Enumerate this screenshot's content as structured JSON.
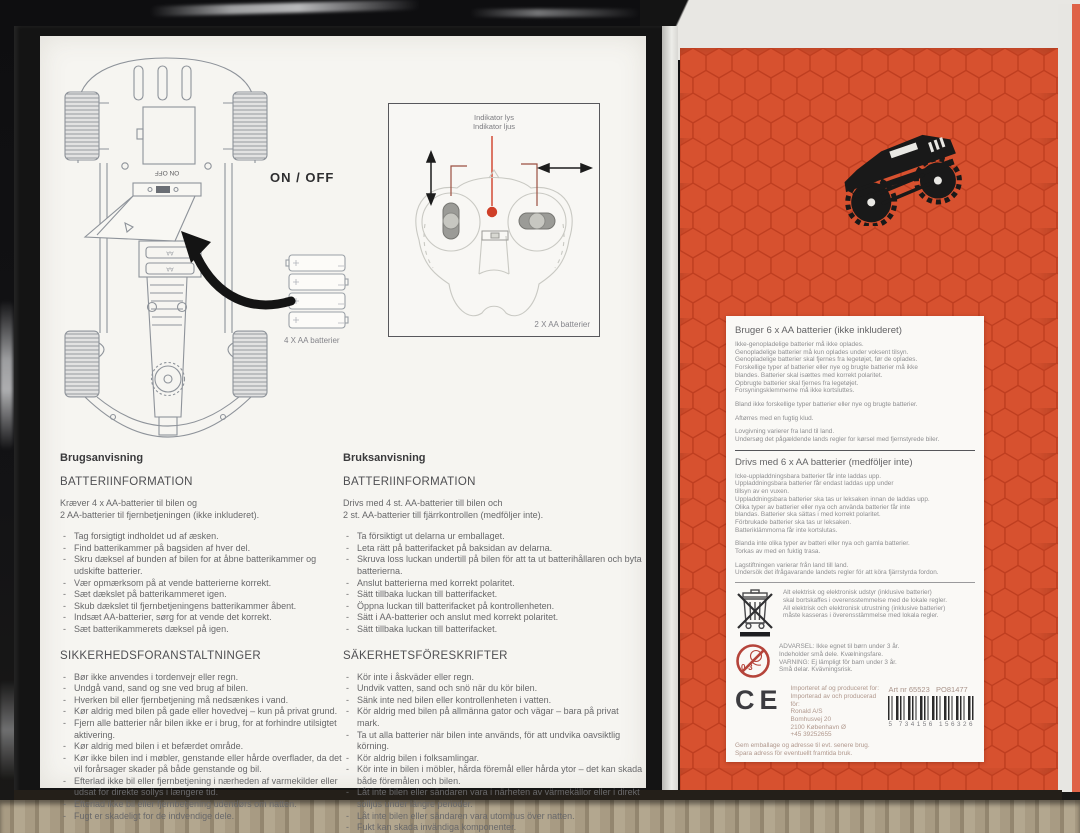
{
  "panel_left": {
    "diagrams": {
      "on_off_label": "ON / OFF",
      "car_batteries_label": "4 X AA batterier",
      "compartment_switch_label": "ON  OFF",
      "battery_slot_label": "AA",
      "remote": {
        "indicator_line1": "Indikator lys",
        "indicator_line2": "Indikator ljus",
        "batteries_label": "2 X AA batterier"
      }
    },
    "danish": {
      "title": "Brugsanvisning",
      "battery_header": "BATTERIINFORMATION",
      "battery_intro": [
        "Kræver 4 x AA-batterier til bilen og",
        "2 AA-batterier til fjernbetjeningen (ikke inkluderet)."
      ],
      "battery_steps": [
        "Tag forsigtigt indholdet ud af æsken.",
        "Find batterikammer på bagsiden af hver del.",
        "Skru dæksel af bunden af bilen for at åbne batterikammer og udskifte batterier.",
        "Vær opmærksom på at vende batterierne korrekt.",
        "Sæt dækslet på batterikammeret igen.",
        "Skub dækslet til fjernbetjeningens batterikammer åbent.",
        "Indsæt AA-batterier, sørg for at vende det korrekt.",
        "Sæt batterikammerets dæksel på igen."
      ],
      "safety_header": "SIKKERHEDSFORANSTALTNINGER",
      "safety_items": [
        "Bør ikke anvendes i tordenvejr eller regn.",
        "Undgå vand, sand og sne ved brug af bilen.",
        "Hverken bil eller fjernbetjening må nedsænkes i vand.",
        "Kør aldrig med bilen på gade eller hovedvej – kun på privat grund.",
        "Fjern alle batterier når bilen ikke er i brug, for at forhindre utilsigtet aktivering.",
        "Kør aldrig med bilen i et befærdet område.",
        "Kør ikke bilen ind i møbler, genstande eller hårde overflader, da det vil forårsager skader på både genstande og bil.",
        "Efterlad ikke bil eller fjernbetjening i nærheden af varmekilder eller udsat for direkte sollys i længere tid.",
        "Efterlad ikke bil eller fjernbetjening udendørs om natten.",
        "Fugt er skadeligt for de indvendige dele."
      ]
    },
    "swedish": {
      "title": "Bruksanvisning",
      "battery_header": "BATTERIINFORMATION",
      "battery_intro": [
        "Drivs med 4 st. AA-batterier till bilen och",
        "2 st. AA-batterier till fjärrkontrollen (medföljer inte)."
      ],
      "battery_steps": [
        "Ta försiktigt ut delarna ur emballaget.",
        "Leta rätt på batterifacket på baksidan av delarna.",
        "Skruva loss luckan undertill på bilen för att ta ut batterihållaren och byta batterierna.",
        "Anslut batterierna med korrekt polaritet.",
        "Sätt tillbaka luckan till batterifacket.",
        "Öppna luckan till batterifacket på kontrollenheten.",
        "Sätt i AA-batterier och anslut med korrekt polaritet.",
        "Sätt tillbaka luckan till batterifacket."
      ],
      "safety_header": "SÄKERHETSFÖRESKRIFTER",
      "safety_items": [
        "Kör inte i åskväder eller regn.",
        "Undvik vatten, sand och snö när du kör bilen.",
        "Sänk inte ned bilen eller kontrollenheten i vatten.",
        "Kör aldrig med bilen på allmänna gator och vägar – bara på privat mark.",
        "Ta ut alla batterier när bilen inte används, för att undvika oavsiktlig körning.",
        "Kör aldrig bilen i folksamlingar.",
        "Kör inte in bilen i möbler, hårda föremål eller hårda ytor – det kan skada både föremålen och bilen.",
        "Låt inte bilen eller sändaren vara i närheten av värmekällor eller i direkt solljus under längre perioder.",
        "Låt inte bilen eller sändaren vara utomhus över natten.",
        "Fukt kan skada invändiga komponenter."
      ]
    }
  },
  "panel_right": {
    "danish": {
      "title": "Bruger 6 x AA batterier (ikke inkluderet)",
      "rules": [
        "Ikke-genopladelige batterier må ikke oplades.",
        "Genopladelige batterier må kun oplades under voksent tilsyn.",
        "Genopladelige batterier skal fjernes fra legetøjet, før de oplades.",
        "Forskellige typer af batterier eller nye og brugte batterier må ikke",
        "blandes. Batterier skal isættes med korrekt polaritet.",
        "Opbrugte batterier skal fjernes fra legetøjet.",
        "Forsyningsklemmerne må ikke kortsluttes."
      ],
      "mix_note": "Bland ikke forskellige typer batterier eller nye og brugte batterier.",
      "clean_note": "Aftørres med en fugtig klud.",
      "law_notes": [
        "Lovgivning varierer fra land til land.",
        "Undersøg det pågældende lands regler for kørsel med fjernstyrede biler."
      ]
    },
    "swedish": {
      "title": "Drivs med 6 x AA batterier (medföljer inte)",
      "rules": [
        "Icke-uppladdningsbara batterier får inte laddas upp.",
        "Uppladdningsbara batterier får endast laddas upp under",
        "tillsyn av en vuxen.",
        "Uppladdningsbara batterier ska tas ur leksaken innan de laddas upp.",
        "Olika typer av batterier eller nya och använda batterier får inte",
        "blandas. Batterier ska sättas i med korrekt polaritet.",
        "Förbrukade batterier ska tas ur leksaken.",
        "Batteriklämmorna får inte kortslutas."
      ],
      "mix_notes": [
        "Blanda inte olika typer av batteri eller nya och gamla batterier.",
        "Torkas av med en fuktig trasa."
      ],
      "law_notes": [
        "Lagstiftningen varierar från land till land.",
        "Undersök det ifrågavarande landets regler för att köra fjärrstyrda fordon."
      ]
    },
    "weee_lines": [
      "Alt elektrisk og elektronisk udstyr (inklusive batterier)",
      "skal bortskaffes i overensstemmelse med de lokale regler.",
      "All elektrisk och elektronisk utrustning (inklusive batterier)",
      "måste kasseras i överensstämmelse med lokala regler."
    ],
    "age_warning_lines": [
      "ADVARSEL: Ikke egnet til børn under 3 år.",
      "Indeholder små dele. Kvælningsfare.",
      "VARNING: Ej lämpligt för barn under 3 år.",
      "Små delar. Kvävningsrisk."
    ],
    "age_badge": "0-3",
    "ce_mark": "CE",
    "importer_lines": [
      "Importeret af og produceret for:",
      "Importerad av och producerad för:",
      "Ronald A/S",
      "Bomhusvej 20",
      "2100 København Ø",
      "+45 39252655"
    ],
    "keep_lines": [
      "Gem emballage og adresse til evt. senere brug.",
      "Spara adress för eventuellt framtida bruk."
    ],
    "art_no": "Art nr 65523",
    "po_no": "PO81477",
    "barcode_digits": "5 734156 156326"
  },
  "colors": {
    "red_panel": "#d7512f",
    "red_dark": "#bf3e20",
    "panel_white": "#f6f5f1",
    "indicator_red": "#cf3f28"
  }
}
